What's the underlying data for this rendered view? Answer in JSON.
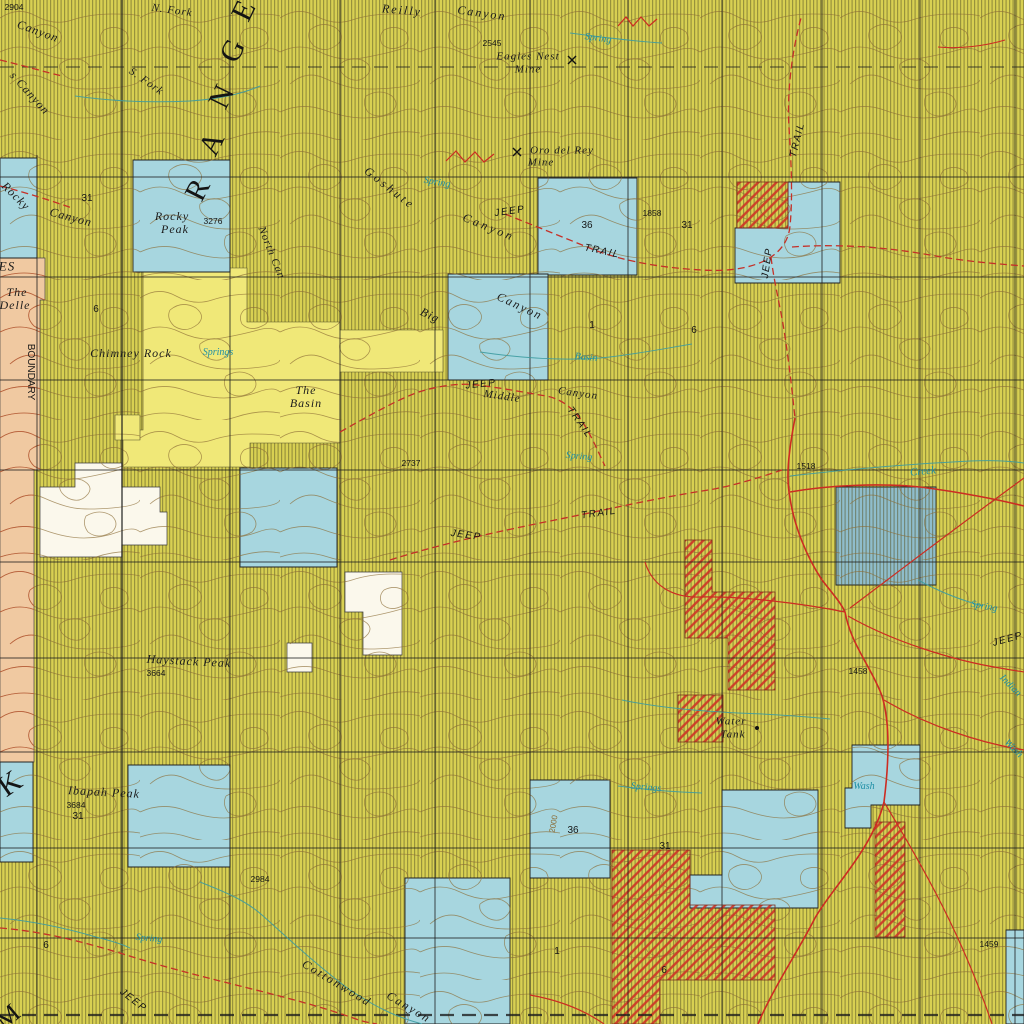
{
  "map": {
    "width": 1024,
    "height": 1024,
    "palette": {
      "base": "#d8d052",
      "hatch": "#565426",
      "bright": "#f0e878",
      "orange": "#f0c9a1",
      "orange_contour": "#c14f30",
      "white": "#fbf8ec",
      "blue": "#a7d6df",
      "dark_blue": "#8fbdcb",
      "contour": "#8a6a33",
      "red": "#cc2c22",
      "trail_red": "#c53028",
      "red_hatch": "#cd3326",
      "stream": "#3d9ba0",
      "grid": "#1e1e1e",
      "water_text": "#1f8fa6"
    },
    "grid": {
      "verticals": [
        37,
        122,
        230,
        340,
        435,
        530,
        628,
        722,
        822,
        920,
        1015
      ],
      "horizontals": [
        67,
        177,
        277,
        380,
        470,
        562,
        658,
        752,
        848,
        938,
        1015
      ]
    },
    "regions": {
      "bright_yellow": [
        "143,268 247,268 247,322 340,322 340,330 443,330 443,372 340,372 340,443 250,443 250,467 123,467 123,430 143,430",
        "115,415 140,415 140,440 115,440"
      ],
      "orange": [
        "0,258 45,258 45,300 40,300 40,470 34,470 34,762 0,762"
      ],
      "white": [
        "75,463 122,463 122,487 160,487 160,512 167,512 167,545 122,545 122,557 40,557 40,487 75,487",
        "345,572 402,572 402,655 363,655 363,612 345,612",
        "287,643 312,643 312,672 287,672"
      ],
      "blue": [
        "0,158 37,158 37,258 0,258",
        "133,160 230,160 230,272 133,272",
        "538,178 637,178 637,275 538,275",
        "735,228 788,228 788,182 840,182 840,283 735,283",
        "448,274 548,274 548,380 448,380",
        "240,468 337,468 337,567 240,567",
        "0,762 33,762 33,862 0,862",
        "128,765 230,765 230,867 128,867",
        "530,780 610,780 610,878 530,878",
        "722,790 818,790 818,908 690,908 690,875 722,875",
        "852,745 920,745 920,805 871,805 871,828 845,828 845,788 852,788",
        "405,878 510,878 510,1024 405,1024",
        "1006,930 1024,930 1024,1024 1006,1024"
      ],
      "dark_blue": [
        "836,487 936,487 936,585 836,585"
      ],
      "red_hatch": [
        "737,182 788,182 788,228 737,228",
        "685,540 712,540 712,592 775,592 775,690 728,690 728,638 685,638",
        "678,695 723,695 723,742 678,742",
        "612,850 690,850 690,905 775,905 775,980 660,980 660,1024 612,1024",
        "875,822 905,822 905,937 875,937"
      ]
    },
    "roads": [
      {
        "d": "M795,418 C788,455 786,478 790,498 C794,525 806,556 822,580 C833,594 841,603 845,612"
      },
      {
        "d": "M790,492 C830,485 880,483 920,487 C960,492 1000,500 1024,506"
      },
      {
        "d": "M850,608 C890,578 950,532 1024,478",
        "w": 1.2
      },
      {
        "d": "M848,616 C890,640 950,660 1000,668 C1010,670 1018,671 1024,672",
        "w": 1.2
      },
      {
        "d": "M845,612 C800,603 740,596 700,597 C672,598 652,585 645,562",
        "w": 1.2
      },
      {
        "d": "M845,612 C851,645 872,668 882,696 C890,722 889,762 884,802"
      },
      {
        "d": "M884,802 C872,850 832,888 815,918 C800,948 772,990 758,1024"
      },
      {
        "d": "M884,802 C922,865 962,935 992,1024",
        "w": 1.2
      },
      {
        "d": "M884,700 C928,726 980,743 1024,750",
        "w": 1.2
      },
      {
        "d": "M530,995 C558,1000 584,1010 604,1024",
        "w": 1.2
      },
      {
        "d": "M618,26 L626,17 L633,26 L641,17 L649,26 L657,19",
        "w": 1.2
      },
      {
        "d": "M446,161 L456,151 L465,162 L475,152 L484,162 L494,154",
        "w": 1.2
      },
      {
        "d": "M1005,40 C985,46 960,49 938,47",
        "w": 1
      }
    ],
    "trails": [
      {
        "d": "M505,214 C535,226 565,238 592,249 C622,261 662,268 702,270 C732,272 756,267 771,257 C783,249 789,238 790,226 C793,196 791,158 789,128 C787,95 791,55 801,18"
      },
      {
        "d": "M792,247 C832,244 880,246 930,255 C968,262 1000,264 1024,266"
      },
      {
        "d": "M771,257 C774,282 780,305 784,330 C789,362 792,390 795,418"
      },
      {
        "d": "M340,432 C372,414 402,397 422,391 C443,385 462,383 477,385 C502,388 522,392 546,396 C562,399 575,409 585,426 C594,441 599,454 605,466"
      },
      {
        "d": "M390,560 C440,544 500,531 560,519 C600,511 652,499 702,491 C730,487 758,478 782,470"
      },
      {
        "d": "M0,928 C40,931 80,941 120,953 C160,966 200,976 240,986 C280,996 320,1006 356,1019 C364,1022 371,1023 377,1024"
      },
      {
        "d": "M0,60 C25,66 45,72 62,76"
      },
      {
        "d": "M0,186 C28,193 52,201 72,208"
      }
    ],
    "streams": [
      {
        "d": "M200,882 C225,892 245,900 262,915 C290,940 320,968 350,990 C380,1010 400,1018 422,1024"
      },
      {
        "d": "M570,33 C600,37 632,41 662,43"
      },
      {
        "d": "M480,352 C520,358 560,361 600,358 C632,355 662,349 692,344"
      },
      {
        "d": "M622,700 C655,707 695,711 738,713 C770,714 800,716 830,719"
      },
      {
        "d": "M618,786 C648,790 676,792 702,793"
      },
      {
        "d": "M75,96 C110,101 150,103 190,101 C220,99 244,93 260,86"
      },
      {
        "d": "M0,918 C30,921 62,927 96,937 C112,941 122,944 130,948"
      },
      {
        "d": "M790,476 C850,469 910,464 970,461 C992,460 1010,461 1024,463"
      },
      {
        "d": "M918,580 C940,592 960,600 983,606"
      }
    ],
    "symbols": [
      {
        "k": "mine",
        "x": 572,
        "y": 60
      },
      {
        "k": "mine",
        "x": 517,
        "y": 152
      },
      {
        "k": "dot",
        "x": 757,
        "y": 728
      }
    ],
    "labels": [
      {
        "t": "2904",
        "x": 14,
        "y": 7,
        "r": 0,
        "s": 8.5,
        "c": "num"
      },
      {
        "t": "Canyon",
        "x": 38,
        "y": 31,
        "r": 20,
        "s": 12,
        "c": "feature"
      },
      {
        "t": "s Canyon",
        "x": 30,
        "y": 93,
        "r": 48,
        "s": 12,
        "c": "feature"
      },
      {
        "t": "N. Fork",
        "x": 172,
        "y": 11,
        "r": 8,
        "s": 11,
        "c": "feature",
        "ls": 1
      },
      {
        "t": "S. Fork",
        "x": 146,
        "y": 82,
        "r": 35,
        "s": 11,
        "c": "feature",
        "ls": 1
      },
      {
        "t": "Reilly",
        "x": 402,
        "y": 10,
        "r": 5,
        "s": 12,
        "c": "feature",
        "ls": 2
      },
      {
        "t": "Canyon",
        "x": 482,
        "y": 13,
        "r": 8,
        "s": 12,
        "c": "feature",
        "ls": 2
      },
      {
        "t": "R",
        "x": 198,
        "y": 190,
        "r": -63,
        "s": 30,
        "c": "big"
      },
      {
        "t": "A",
        "x": 212,
        "y": 144,
        "r": -64,
        "s": 30,
        "c": "big"
      },
      {
        "t": "N",
        "x": 222,
        "y": 97,
        "r": -64,
        "s": 30,
        "c": "big"
      },
      {
        "t": "G",
        "x": 233,
        "y": 51,
        "r": -64,
        "s": 30,
        "c": "big"
      },
      {
        "t": "E",
        "x": 244,
        "y": 11,
        "r": -64,
        "s": 30,
        "c": "big"
      },
      {
        "t": "Eagles Nest",
        "x": 528,
        "y": 57,
        "r": 0,
        "s": 11,
        "c": "feature"
      },
      {
        "t": "Mine",
        "x": 528,
        "y": 70,
        "r": 0,
        "s": 11,
        "c": "feature"
      },
      {
        "t": "2545",
        "x": 492,
        "y": 43,
        "r": 0,
        "s": 8.5,
        "c": "num"
      },
      {
        "t": "Spring",
        "x": 598,
        "y": 39,
        "r": 8,
        "s": 10,
        "c": "water"
      },
      {
        "t": "Goshute",
        "x": 390,
        "y": 188,
        "r": 38,
        "s": 12,
        "c": "feature",
        "ls": 3
      },
      {
        "t": "Canyon",
        "x": 489,
        "y": 227,
        "r": 22,
        "s": 12,
        "c": "feature",
        "ls": 3
      },
      {
        "t": "Spring",
        "x": 437,
        "y": 183,
        "r": 10,
        "s": 10,
        "c": "water"
      },
      {
        "t": "JEEP",
        "x": 510,
        "y": 212,
        "r": -8,
        "s": 10,
        "c": "trail"
      },
      {
        "t": "TRAIL",
        "x": 602,
        "y": 252,
        "r": 12,
        "s": 10,
        "c": "trail"
      },
      {
        "t": "Oro del Rey",
        "x": 562,
        "y": 151,
        "r": 0,
        "s": 11,
        "c": "feature"
      },
      {
        "t": "Mine",
        "x": 541,
        "y": 163,
        "r": 0,
        "s": 11,
        "c": "feature"
      },
      {
        "t": "36",
        "x": 587,
        "y": 226,
        "r": 0,
        "s": 10,
        "c": "num"
      },
      {
        "t": "1858",
        "x": 652,
        "y": 213,
        "r": 0,
        "s": 8.5,
        "c": "num"
      },
      {
        "t": "31",
        "x": 687,
        "y": 226,
        "r": 0,
        "s": 10,
        "c": "num"
      },
      {
        "t": "TRAIL",
        "x": 798,
        "y": 140,
        "r": -76,
        "s": 10,
        "c": "trail"
      },
      {
        "t": "JEEP",
        "x": 768,
        "y": 263,
        "r": -82,
        "s": 10,
        "c": "trail"
      },
      {
        "t": "Rocky",
        "x": 16,
        "y": 196,
        "r": 45,
        "s": 12,
        "c": "feature"
      },
      {
        "t": "Canyon",
        "x": 71,
        "y": 217,
        "r": 15,
        "s": 12,
        "c": "feature"
      },
      {
        "t": "31",
        "x": 87,
        "y": 199,
        "r": 0,
        "s": 10,
        "c": "num"
      },
      {
        "t": "Rocky",
        "x": 172,
        "y": 216,
        "r": 0,
        "s": 12,
        "c": "feature"
      },
      {
        "t": "Peak",
        "x": 175,
        "y": 229,
        "r": 0,
        "s": 12,
        "c": "feature"
      },
      {
        "t": "3276",
        "x": 213,
        "y": 221,
        "r": 0,
        "s": 8.5,
        "c": "num"
      },
      {
        "t": "North Can",
        "x": 271,
        "y": 253,
        "r": 68,
        "s": 11,
        "c": "feature"
      },
      {
        "t": "ES",
        "x": 7,
        "y": 266,
        "r": 0,
        "s": 13,
        "c": "feature"
      },
      {
        "t": "The",
        "x": 17,
        "y": 292,
        "r": 0,
        "s": 12,
        "c": "feature"
      },
      {
        "t": "Delle",
        "x": 15,
        "y": 305,
        "r": 0,
        "s": 12,
        "c": "feature"
      },
      {
        "t": "BOUNDARY",
        "x": 30,
        "y": 372,
        "r": 90,
        "s": 10,
        "c": "num"
      },
      {
        "t": "6",
        "x": 96,
        "y": 310,
        "r": 0,
        "s": 10,
        "c": "num"
      },
      {
        "t": "Chimney Rock",
        "x": 131,
        "y": 353,
        "r": 0,
        "s": 12,
        "c": "feature"
      },
      {
        "t": "Springs",
        "x": 218,
        "y": 353,
        "r": 0,
        "s": 10,
        "c": "water"
      },
      {
        "t": "The",
        "x": 306,
        "y": 390,
        "r": 0,
        "s": 12,
        "c": "feature"
      },
      {
        "t": "Basin",
        "x": 306,
        "y": 403,
        "r": 0,
        "s": 12,
        "c": "feature"
      },
      {
        "t": "Big",
        "x": 430,
        "y": 315,
        "r": 25,
        "s": 12,
        "c": "feature"
      },
      {
        "t": "Canyon",
        "x": 520,
        "y": 306,
        "r": 25,
        "s": 12,
        "c": "feature",
        "ls": 2
      },
      {
        "t": "1",
        "x": 592,
        "y": 326,
        "r": 0,
        "s": 10,
        "c": "num"
      },
      {
        "t": "6",
        "x": 694,
        "y": 331,
        "r": 0,
        "s": 10,
        "c": "num"
      },
      {
        "t": "Basin",
        "x": 586,
        "y": 358,
        "r": 5,
        "s": 10,
        "c": "water"
      },
      {
        "t": "JEEP",
        "x": 481,
        "y": 385,
        "r": -6,
        "s": 10,
        "c": "trail"
      },
      {
        "t": "Middle",
        "x": 502,
        "y": 397,
        "r": 8,
        "s": 11,
        "c": "feature"
      },
      {
        "t": "Canyon",
        "x": 578,
        "y": 394,
        "r": 8,
        "s": 11,
        "c": "feature"
      },
      {
        "t": "TRAIL",
        "x": 579,
        "y": 423,
        "r": 55,
        "s": 10,
        "c": "trail"
      },
      {
        "t": "Spring",
        "x": 579,
        "y": 457,
        "r": 5,
        "s": 10,
        "c": "water"
      },
      {
        "t": "2737",
        "x": 411,
        "y": 463,
        "r": 0,
        "s": 8.5,
        "c": "num"
      },
      {
        "t": "1518",
        "x": 806,
        "y": 466,
        "r": 0,
        "s": 8.5,
        "c": "num"
      },
      {
        "t": "Creek",
        "x": 923,
        "y": 472,
        "r": -5,
        "s": 11,
        "c": "water"
      },
      {
        "t": "JEEP",
        "x": 466,
        "y": 536,
        "r": 8,
        "s": 10,
        "c": "trail"
      },
      {
        "t": "TRAIL",
        "x": 599,
        "y": 514,
        "r": -8,
        "s": 10,
        "c": "trail"
      },
      {
        "t": "Haystack Peak",
        "x": 189,
        "y": 661,
        "r": 3,
        "s": 12,
        "c": "feature"
      },
      {
        "t": "3664",
        "x": 156,
        "y": 673,
        "r": 0,
        "s": 8.5,
        "c": "num"
      },
      {
        "t": "Water",
        "x": 731,
        "y": 722,
        "r": 0,
        "s": 11,
        "c": "feature"
      },
      {
        "t": "Tank",
        "x": 733,
        "y": 735,
        "r": 0,
        "s": 11,
        "c": "feature"
      },
      {
        "t": "1458",
        "x": 858,
        "y": 671,
        "r": 0,
        "s": 8.5,
        "c": "num"
      },
      {
        "t": "Springs",
        "x": 646,
        "y": 788,
        "r": 5,
        "s": 10,
        "c": "water"
      },
      {
        "t": "Wash",
        "x": 864,
        "y": 787,
        "r": 0,
        "s": 10,
        "c": "water"
      },
      {
        "t": "Ibapah Peak",
        "x": 104,
        "y": 792,
        "r": 3,
        "s": 12,
        "c": "feature"
      },
      {
        "t": "3684",
        "x": 76,
        "y": 805,
        "r": 0,
        "s": 8.5,
        "c": "num"
      },
      {
        "t": "31",
        "x": 78,
        "y": 817,
        "r": 0,
        "s": 10,
        "c": "num"
      },
      {
        "t": "K",
        "x": 10,
        "y": 784,
        "r": -35,
        "s": 30,
        "c": "big"
      },
      {
        "t": "2984",
        "x": 260,
        "y": 879,
        "r": 0,
        "s": 8.5,
        "c": "num"
      },
      {
        "t": "36",
        "x": 573,
        "y": 831,
        "r": 0,
        "s": 10,
        "c": "num"
      },
      {
        "t": "2000",
        "x": 554,
        "y": 824,
        "r": -80,
        "s": 8,
        "c": "contour"
      },
      {
        "t": "31",
        "x": 665,
        "y": 847,
        "r": 0,
        "s": 10,
        "c": "num"
      },
      {
        "t": "1",
        "x": 557,
        "y": 952,
        "r": 0,
        "s": 10,
        "c": "num"
      },
      {
        "t": "6",
        "x": 664,
        "y": 971,
        "r": 0,
        "s": 10,
        "c": "num"
      },
      {
        "t": "6",
        "x": 46,
        "y": 946,
        "r": 0,
        "s": 10,
        "c": "num"
      },
      {
        "t": "Spring",
        "x": 149,
        "y": 939,
        "r": 5,
        "s": 10,
        "c": "water"
      },
      {
        "t": "JEEP",
        "x": 133,
        "y": 1001,
        "r": 38,
        "s": 10,
        "c": "trail"
      },
      {
        "t": "M",
        "x": 8,
        "y": 1017,
        "r": -40,
        "s": 26,
        "c": "big"
      },
      {
        "t": "Cottonwood",
        "x": 337,
        "y": 983,
        "r": 31,
        "s": 12,
        "c": "feature",
        "ls": 2
      },
      {
        "t": "Canyon",
        "x": 409,
        "y": 1007,
        "r": 31,
        "s": 12,
        "c": "feature",
        "ls": 2
      },
      {
        "t": "JEEP",
        "x": 1008,
        "y": 640,
        "r": -15,
        "s": 10,
        "c": "trail"
      },
      {
        "t": "Indian",
        "x": 1010,
        "y": 686,
        "r": 45,
        "s": 10,
        "c": "water"
      },
      {
        "t": "Wash",
        "x": 1013,
        "y": 749,
        "r": 45,
        "s": 10,
        "c": "water"
      },
      {
        "t": "1459",
        "x": 989,
        "y": 944,
        "r": 0,
        "s": 8.5,
        "c": "num"
      },
      {
        "t": "Spring",
        "x": 984,
        "y": 607,
        "r": 10,
        "s": 10,
        "c": "water"
      }
    ]
  }
}
